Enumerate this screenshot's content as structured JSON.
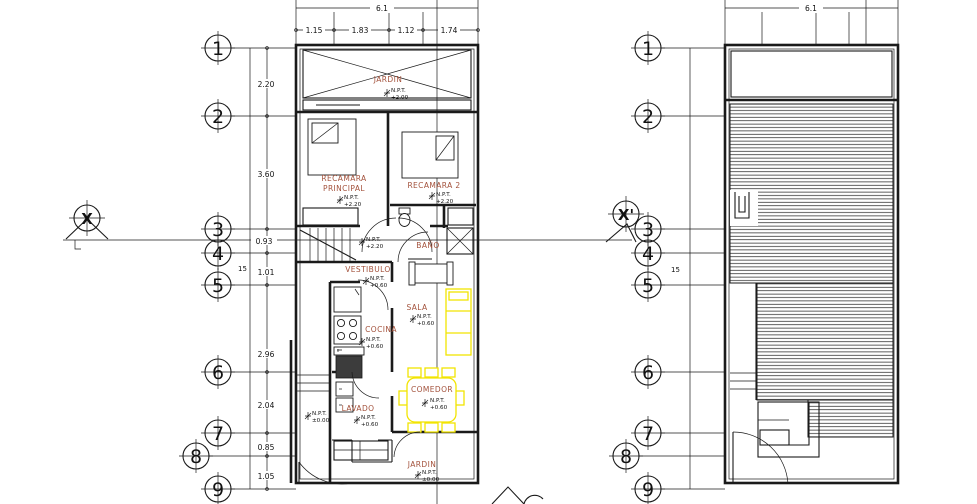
{
  "drawing": {
    "type": "architectural-floor-plan",
    "colors": {
      "line": "#1a1a1a",
      "room_label": "#A3523C",
      "furniture_accent": "#F2E400",
      "background": "#ffffff"
    }
  },
  "grid": {
    "left_numbers": [
      "1",
      "2",
      "3",
      "4",
      "5",
      "6",
      "7",
      "8",
      "9"
    ],
    "right_numbers": [
      "1",
      "2",
      "3",
      "4",
      "5",
      "6",
      "7",
      "8",
      "9"
    ],
    "section_left": "X",
    "section_right": "X'"
  },
  "dimensions": {
    "left_plan": {
      "total_width": "6.1",
      "top_segments": [
        "1.15",
        "1.83",
        "1.12",
        "1.74"
      ],
      "total_height": "15",
      "side_segments": [
        "2.20",
        "3.60",
        "0.93",
        "1.01",
        "2.96",
        "2.04",
        "0.85",
        "1.05"
      ]
    },
    "right_plan": {
      "total_width": "6.1",
      "total_height": "15"
    }
  },
  "rooms": {
    "jardin_top": {
      "name": "JARDIN",
      "npt": "N.P.T.",
      "level": "+2.00"
    },
    "recamara_principal": {
      "name_line1": "RECAMARA",
      "name_line2": "PRINCIPAL",
      "npt": "N.P.T.",
      "level": "+2.20"
    },
    "recamara_2": {
      "name": "RECAMARA 2",
      "npt": "N.P.T.",
      "level": "+2.20"
    },
    "bano": {
      "name": "BAÑO"
    },
    "stair_landing": {
      "npt": "N.P.T.",
      "level": "+2.20"
    },
    "vestibulo": {
      "name": "VESTIBULO",
      "npt": "N.P.T.",
      "level": "+0.60"
    },
    "sala": {
      "name": "SALA",
      "npt": "N.P.T.",
      "level": "+0.60"
    },
    "cocina": {
      "name": "COCINA",
      "npt": "N.P.T.",
      "level": "+0.60"
    },
    "lavado": {
      "name": "LAVADO",
      "npt": "N.P.T.",
      "level": "+0.60"
    },
    "comedor": {
      "name": "COMEDOR",
      "npt": "N.P.T.",
      "level": "+0.60"
    },
    "jardin_bottom": {
      "name": "JARDIN",
      "npt": "N.P.T.",
      "level": "±0.00"
    },
    "exterior_side": {
      "npt": "N.P.T.",
      "level": "±0.00"
    }
  }
}
